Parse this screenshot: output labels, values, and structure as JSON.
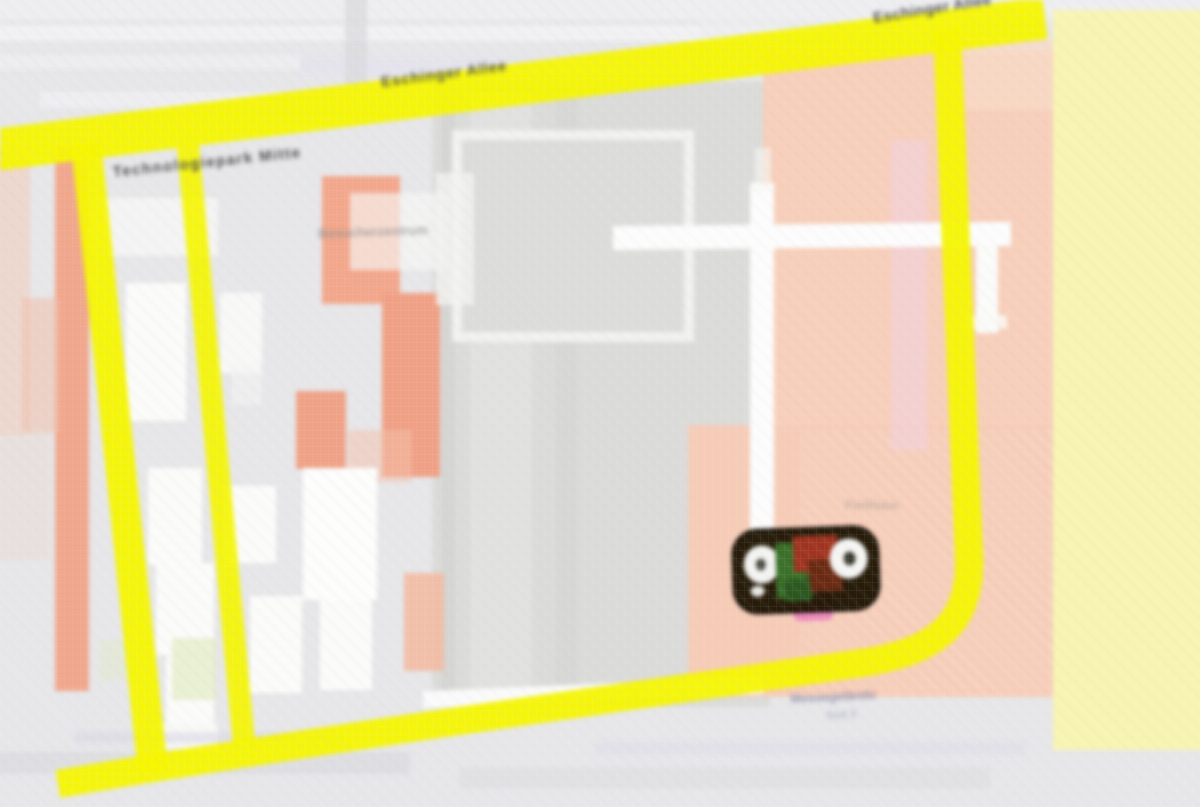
{
  "map": {
    "kind": "street-map-tile",
    "description": "Heavily pixelated (up-scaled low-resolution) street map. Bright yellow major roads bound a campus-like block: a diagonal avenue across the top, two parallel yellow streets on the left, a vertical yellow road on the right curving into a bottom avenue. Left half holds white and orange buildings on gray; right half is a large salmon block crossed by white paths, with a pale-yellow block at the far right. A dark highlighted POI label-cluster sits in the salmon area right of center.",
    "legibility_note": "All street and place names in the source are blurred beyond legibility; label texts below are approximate blurred-shape stand-ins, not confirmed readings.",
    "palette": {
      "background_gray": "#e7e7e9",
      "central_block_gray": "#dbdbd9",
      "road_yellow": "#f5f500",
      "pale_yellow_block": "#f8f4b2",
      "salmon_area": "#f7cfba",
      "orange_building": "#f0a084",
      "white_road": "#fcfcfc",
      "marker_dark": "#1f1502",
      "marker_green": "#3a7028",
      "marker_red": "#a03420",
      "marker_pink": "#ee8abc",
      "label_dark": "#52524e",
      "label_faint_blue": "#8486a6"
    },
    "labels": [
      {
        "id": "road-label-top-center",
        "text": "Eschinger Allee",
        "placement": "along diagonal top road, center",
        "legible": false
      },
      {
        "id": "road-label-top-right",
        "text": "Eschinger Allee",
        "placement": "along diagonal top road, upper right",
        "legible": false
      },
      {
        "id": "street-label-upper-left",
        "text": "Technologiepark Mitte",
        "placement": "upper left block, slight diagonal",
        "legible": false
      },
      {
        "id": "place-label-center-left",
        "text": "Besucherzentrum",
        "placement": "faint gray label near orange building, center-left",
        "legible": false
      },
      {
        "id": "place-label-salmon-area",
        "text": "Parkhaus",
        "placement": "very faint label in salmon area above marker",
        "legible": false
      },
      {
        "id": "place-label-bottom",
        "text": "Messegelände",
        "placement": "faint bluish label under bottom yellow road",
        "legible": false
      },
      {
        "id": "place-label-bottom-2",
        "text": "Süd 3",
        "placement": "second fainter line below",
        "legible": false
      }
    ],
    "marker_cluster": {
      "name": "highlighted-poi-cluster",
      "description": "Dark rounded label blob with two white circular icons, green and red/brown patches, pink tag peeking below",
      "approx_position": {
        "x": 805,
        "y": 570
      }
    },
    "roads": [
      {
        "id": "top-diagonal-avenue",
        "color": "#f5f500"
      },
      {
        "id": "left-street-1",
        "color": "#f5f500"
      },
      {
        "id": "left-street-2",
        "color": "#f5f500"
      },
      {
        "id": "right-vertical-to-bottom-avenue",
        "color": "#f5f500"
      },
      {
        "id": "white-path-horizontal",
        "color": "#fcfcfc"
      },
      {
        "id": "white-path-vertical",
        "color": "#fcfcfc"
      }
    ]
  }
}
